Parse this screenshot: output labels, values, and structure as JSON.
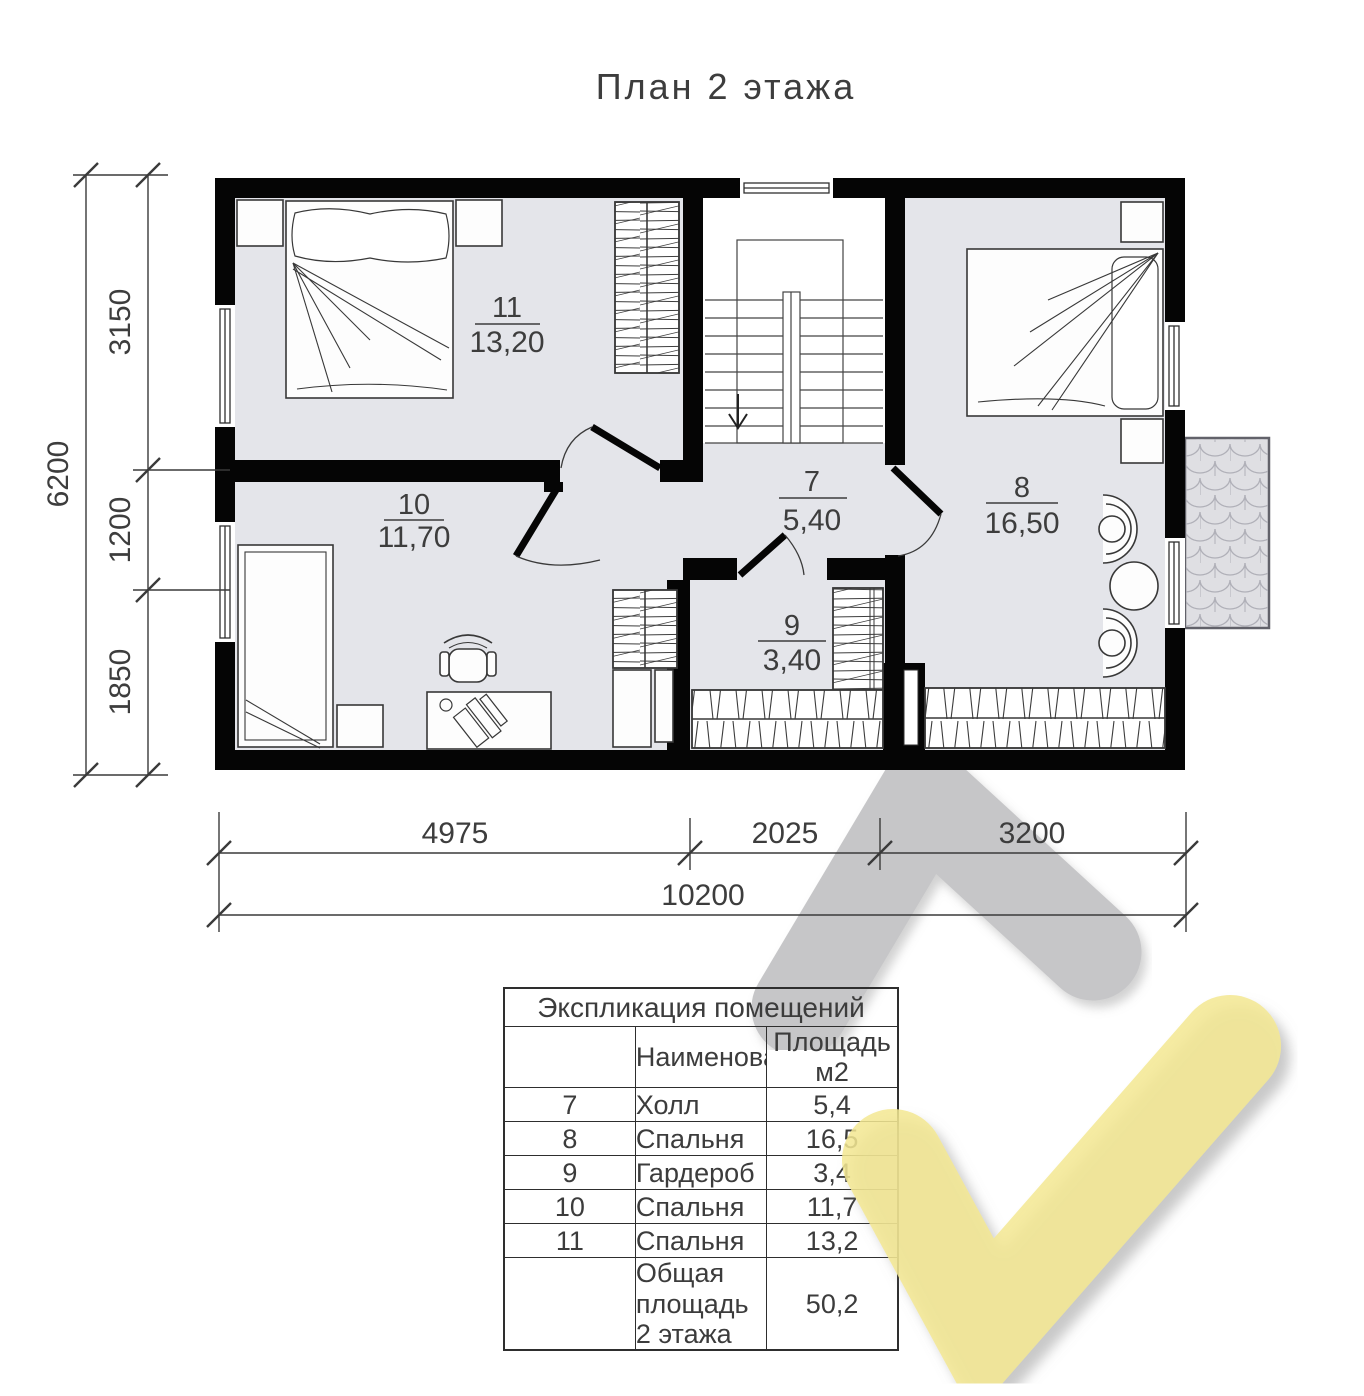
{
  "title": "План 2 этажа",
  "plan": {
    "rooms": {
      "r7": {
        "number": "7",
        "area": "5,40"
      },
      "r8": {
        "number": "8",
        "area": "16,50"
      },
      "r9": {
        "number": "9",
        "area": "3,40"
      },
      "r10": {
        "number": "10",
        "area": "11,70"
      },
      "r11": {
        "number": "11",
        "area": "13,20"
      }
    },
    "dims": {
      "left": [
        "3150",
        "1200",
        "1850"
      ],
      "left_total": "6200",
      "bottom": [
        "4975",
        "2025",
        "3200"
      ],
      "bottom_total": "10200"
    }
  },
  "table": {
    "caption": "Экспликация помещений",
    "columns": {
      "name": "Наименование",
      "area_line1": "Площадь",
      "area_line2": "м2"
    },
    "rows": [
      {
        "num": "7",
        "name": "Холл",
        "area": "5,4"
      },
      {
        "num": "8",
        "name": "Спальня",
        "area": "16,5"
      },
      {
        "num": "9",
        "name": "Гардероб",
        "area": "3,4"
      },
      {
        "num": "10",
        "name": "Спальня",
        "area": "11,7"
      },
      {
        "num": "11",
        "name": "Спальня",
        "area": "13,2"
      }
    ],
    "total": {
      "label_line1": "Общая площадь",
      "label_line2": "2 этажа",
      "area": "50,2"
    }
  },
  "colors": {
    "floor": "#e4e5ea",
    "wall": "#050505",
    "watermark_gray": "#c6c6c8",
    "watermark_yellow": "#f3e792",
    "balcony": "#dfdfe3"
  }
}
